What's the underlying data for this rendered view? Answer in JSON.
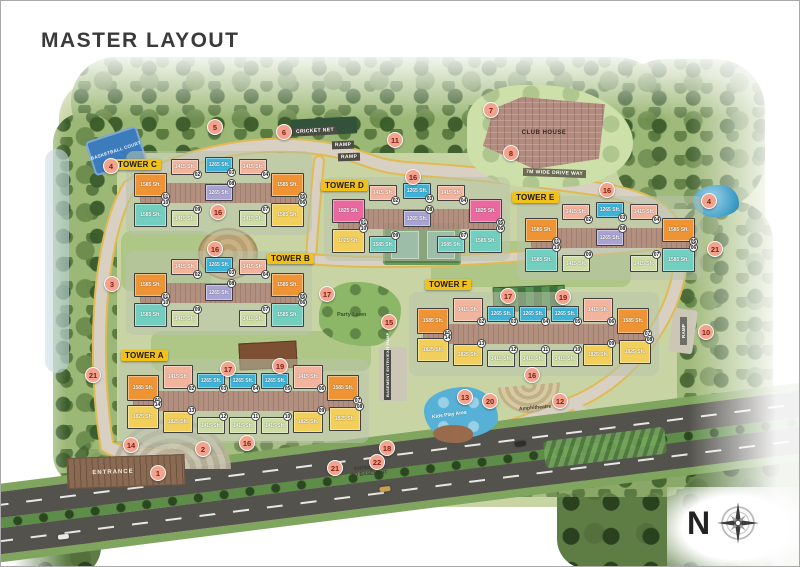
{
  "title": "MASTER LAYOUT",
  "colors": {
    "orange": "#ef9434",
    "salmon": "#f2b49c",
    "blue": "#3eb3d8",
    "purple": "#a9a3d4",
    "teal": "#72cfc0",
    "green": "#cedda4",
    "yellow": "#f2cf5b",
    "magenta": "#e9699f",
    "marker_bg": "#f2a38e",
    "marker_text": "#7c2014",
    "tower_label_bg": "#f2c119"
  },
  "labels": {
    "cricket_net": "CRICKET NET",
    "ramp": "RAMP",
    "drive_way": "7M WIDE DRIVE WAY",
    "club_house": "CLUB HOUSE",
    "party_lawn": "Party Lawn",
    "kids_play": "Kids Play Area",
    "amphitheatre": "Amphitheatre",
    "entrance": "ENTRANCE",
    "entry_exit_basement": "ENTRY/EXIT\nTO BASEMENT",
    "basement_ramp": "BASEMENT ENTRY/EXIT RAMP",
    "basketball_court": "BASKETBALL COURT",
    "compass_n": "N"
  },
  "towers": [
    {
      "id": "C",
      "label": "TOWER C",
      "type": "t10",
      "x": 133,
      "y": 156,
      "lx": 113,
      "ly": 158,
      "units": [
        {
          "n": "01",
          "size": "1585 Sft.",
          "color": "orange"
        },
        {
          "n": "02",
          "size": "1415 Sft.",
          "color": "salmon"
        },
        {
          "n": "03",
          "size": "1265 Sft.",
          "color": "blue"
        },
        {
          "n": "04",
          "size": "1415 Sft.",
          "color": "salmon"
        },
        {
          "n": "05",
          "size": "1585 Sft.",
          "color": "orange"
        },
        {
          "n": "06",
          "size": "1585 Sft.",
          "color": "yellow"
        },
        {
          "n": "07",
          "size": "1415 Sft.",
          "color": "green"
        },
        {
          "n": "08",
          "size": "1265 Sft.",
          "color": "purple"
        },
        {
          "n": "09",
          "size": "1415 Sft.",
          "color": "green"
        },
        {
          "n": "10",
          "size": "1585 Sft.",
          "color": "teal"
        }
      ]
    },
    {
      "id": "B",
      "label": "TOWER B",
      "type": "t10",
      "x": 133,
      "y": 256,
      "lx": 266,
      "ly": 252,
      "units": [
        {
          "n": "01",
          "size": "1585 Sft.",
          "color": "orange"
        },
        {
          "n": "02",
          "size": "1415 Sft.",
          "color": "salmon"
        },
        {
          "n": "03",
          "size": "1265 Sft.",
          "color": "blue"
        },
        {
          "n": "04",
          "size": "1415 Sft.",
          "color": "salmon"
        },
        {
          "n": "05",
          "size": "1585 Sft.",
          "color": "orange"
        },
        {
          "n": "06",
          "size": "1585 Sft.",
          "color": "teal"
        },
        {
          "n": "07",
          "size": "1415 Sft.",
          "color": "green"
        },
        {
          "n": "08",
          "size": "1265 Sft.",
          "color": "purple"
        },
        {
          "n": "09",
          "size": "1415 Sft.",
          "color": "green"
        },
        {
          "n": "10",
          "size": "1585 Sft.",
          "color": "teal"
        }
      ]
    },
    {
      "id": "D",
      "label": "TOWER D",
      "type": "t10",
      "x": 331,
      "y": 182,
      "lx": 320,
      "ly": 179,
      "units": [
        {
          "n": "01",
          "size": "1825 Sft.",
          "color": "magenta"
        },
        {
          "n": "02",
          "size": "1415 Sft.",
          "color": "salmon"
        },
        {
          "n": "03",
          "size": "1265 Sft.",
          "color": "blue"
        },
        {
          "n": "04",
          "size": "1415 Sft.",
          "color": "salmon"
        },
        {
          "n": "05",
          "size": "1825 Sft.",
          "color": "magenta"
        },
        {
          "n": "06",
          "size": "1585 Sft.",
          "color": "teal"
        },
        {
          "n": "07",
          "size": "1585 Sft.",
          "color": "teal"
        },
        {
          "n": "08",
          "size": "1265 Sft.",
          "color": "purple"
        },
        {
          "n": "09",
          "size": "1585 Sft.",
          "color": "teal"
        },
        {
          "n": "10",
          "size": "1025 Sft.",
          "color": "yellow"
        }
      ]
    },
    {
      "id": "E",
      "label": "TOWER E",
      "type": "t10",
      "x": 524,
      "y": 201,
      "lx": 511,
      "ly": 191,
      "units": [
        {
          "n": "01",
          "size": "1585 Sft.",
          "color": "orange"
        },
        {
          "n": "02",
          "size": "1415 Sft.",
          "color": "salmon"
        },
        {
          "n": "03",
          "size": "1265 Sft.",
          "color": "blue"
        },
        {
          "n": "04",
          "size": "1415 Sft.",
          "color": "salmon"
        },
        {
          "n": "05",
          "size": "1585 Sft.",
          "color": "orange"
        },
        {
          "n": "06",
          "size": "1585 Sft.",
          "color": "teal"
        },
        {
          "n": "07",
          "size": "1415 Sft.",
          "color": "green"
        },
        {
          "n": "08",
          "size": "1265 Sft.",
          "color": "purple"
        },
        {
          "n": "09",
          "size": "1415 Sft.",
          "color": "green"
        },
        {
          "n": "10",
          "size": "1585 Sft.",
          "color": "teal"
        }
      ]
    },
    {
      "id": "A",
      "label": "TOWER A",
      "type": "t14",
      "x": 126,
      "y": 364,
      "lx": 120,
      "ly": 349,
      "units": [
        {
          "n": "01",
          "size": "1585 Sft.",
          "color": "orange"
        },
        {
          "n": "02",
          "size": "1415 Sft.",
          "color": "salmon"
        },
        {
          "n": "03",
          "size": "1265 Sft.",
          "color": "blue"
        },
        {
          "n": "04",
          "size": "1265 Sft.",
          "color": "blue"
        },
        {
          "n": "05",
          "size": "1265 Sft.",
          "color": "blue"
        },
        {
          "n": "06",
          "size": "1415 Sft.",
          "color": "salmon"
        },
        {
          "n": "07",
          "size": "1585 Sft.",
          "color": "orange"
        },
        {
          "n": "08",
          "size": "1825 Sft.",
          "color": "yellow"
        },
        {
          "n": "09",
          "size": "1825 Sft.",
          "color": "yellow"
        },
        {
          "n": "10",
          "size": "1415 Sft.",
          "color": "green"
        },
        {
          "n": "11",
          "size": "1415 Sft.",
          "color": "green"
        },
        {
          "n": "12",
          "size": "1415 Sft.",
          "color": "green"
        },
        {
          "n": "13",
          "size": "1825 Sft.",
          "color": "yellow"
        },
        {
          "n": "14",
          "size": "1825 Sft.",
          "color": "yellow"
        }
      ]
    },
    {
      "id": "F",
      "label": "TOWER F",
      "type": "t14",
      "x": 416,
      "y": 297,
      "lx": 424,
      "ly": 278,
      "units": [
        {
          "n": "01",
          "size": "1585 Sft.",
          "color": "orange"
        },
        {
          "n": "02",
          "size": "1415 Sft.",
          "color": "salmon"
        },
        {
          "n": "03",
          "size": "1265 Sft.",
          "color": "blue"
        },
        {
          "n": "04",
          "size": "1265 Sft.",
          "color": "blue"
        },
        {
          "n": "05",
          "size": "1265 Sft.",
          "color": "blue"
        },
        {
          "n": "06",
          "size": "1415 Sft.",
          "color": "salmon"
        },
        {
          "n": "07",
          "size": "1585 Sft.",
          "color": "orange"
        },
        {
          "n": "08",
          "size": "1825 Sft.",
          "color": "yellow"
        },
        {
          "n": "09",
          "size": "1825 Sft.",
          "color": "yellow"
        },
        {
          "n": "10",
          "size": "1415 Sft.",
          "color": "green"
        },
        {
          "n": "11",
          "size": "1415 Sft.",
          "color": "green"
        },
        {
          "n": "12",
          "size": "1415 Sft.",
          "color": "green"
        },
        {
          "n": "13",
          "size": "1825 Sft.",
          "color": "yellow"
        },
        {
          "n": "14",
          "size": "1825 Sft.",
          "color": "yellow"
        }
      ]
    }
  ],
  "markers": [
    {
      "n": "1",
      "x": 157,
      "y": 472
    },
    {
      "n": "2",
      "x": 202,
      "y": 448
    },
    {
      "n": "3",
      "x": 111,
      "y": 283
    },
    {
      "n": "4",
      "x": 110,
      "y": 165
    },
    {
      "n": "4",
      "x": 708,
      "y": 200
    },
    {
      "n": "5",
      "x": 214,
      "y": 126
    },
    {
      "n": "6",
      "x": 283,
      "y": 131
    },
    {
      "n": "7",
      "x": 490,
      "y": 109
    },
    {
      "n": "8",
      "x": 510,
      "y": 152
    },
    {
      "n": "10",
      "x": 705,
      "y": 331
    },
    {
      "n": "11",
      "x": 394,
      "y": 139
    },
    {
      "n": "12",
      "x": 559,
      "y": 400
    },
    {
      "n": "13",
      "x": 464,
      "y": 396
    },
    {
      "n": "14",
      "x": 130,
      "y": 444
    },
    {
      "n": "15",
      "x": 388,
      "y": 321
    },
    {
      "n": "16",
      "x": 217,
      "y": 211
    },
    {
      "n": "16",
      "x": 214,
      "y": 248
    },
    {
      "n": "16",
      "x": 412,
      "y": 176
    },
    {
      "n": "16",
      "x": 606,
      "y": 189
    },
    {
      "n": "16",
      "x": 246,
      "y": 442
    },
    {
      "n": "16",
      "x": 531,
      "y": 374
    },
    {
      "n": "17",
      "x": 326,
      "y": 293
    },
    {
      "n": "17",
      "x": 227,
      "y": 368
    },
    {
      "n": "17",
      "x": 507,
      "y": 295
    },
    {
      "n": "18",
      "x": 386,
      "y": 447
    },
    {
      "n": "19",
      "x": 279,
      "y": 365
    },
    {
      "n": "19",
      "x": 562,
      "y": 296
    },
    {
      "n": "20",
      "x": 489,
      "y": 400
    },
    {
      "n": "21",
      "x": 92,
      "y": 374
    },
    {
      "n": "21",
      "x": 714,
      "y": 248
    },
    {
      "n": "21",
      "x": 334,
      "y": 467
    },
    {
      "n": "22",
      "x": 376,
      "y": 461
    }
  ]
}
